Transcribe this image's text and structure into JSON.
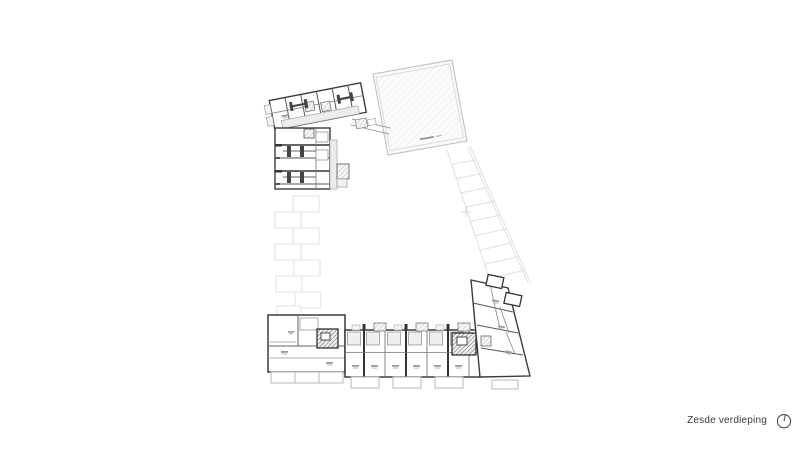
{
  "sheet": {
    "caption": "Zesde verdieping"
  },
  "icons": {
    "north_arrow": "north-arrow-icon"
  },
  "colors": {
    "background": "#ffffff",
    "wall": "#3c3c3c",
    "partition": "#777777",
    "corridor_fill": "#ececec",
    "ghost_line": "#dfe2e5",
    "roof_hatch": "#e3e3e3",
    "roof_border": "#bdbdbd",
    "balcony_line": "#b8b8b8",
    "caption_text": "#3a3a3a"
  },
  "plan": {
    "areas": [
      {
        "id": "roof-block"
      },
      {
        "id": "northwest-wing"
      },
      {
        "id": "west-wing"
      },
      {
        "id": "south-wing"
      },
      {
        "id": "southeast-block"
      },
      {
        "id": "ghost-left-lower-floor"
      },
      {
        "id": "ghost-right-lower-floor"
      }
    ]
  }
}
